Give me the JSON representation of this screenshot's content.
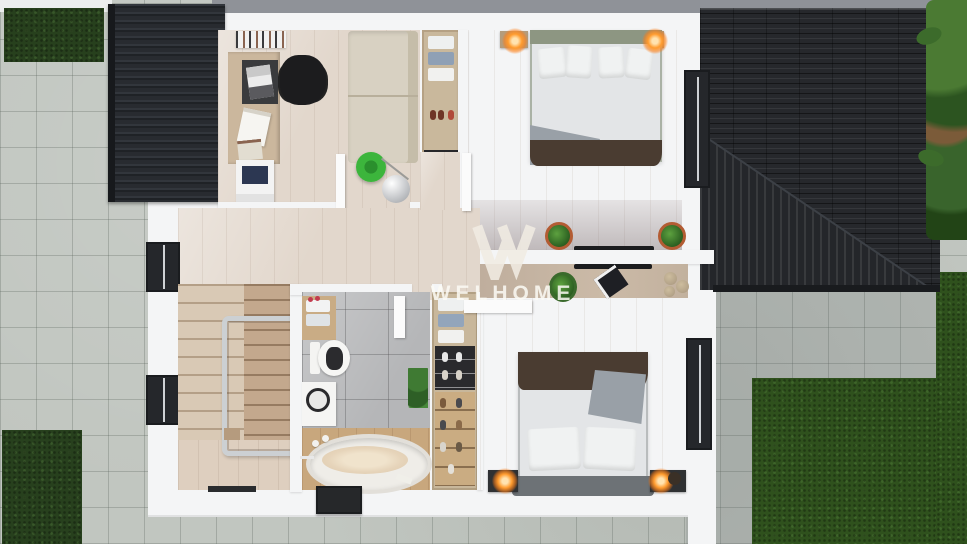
{
  "watermark": {
    "symbol": "W",
    "brand": "WELHOME"
  },
  "palette": {
    "paver": "#c1c6c0",
    "paver-line": "#99a099",
    "grass-dark": "#27401d",
    "grass-bright": "#2f511d",
    "roof": "#26282c",
    "wall": "#f4f5f6",
    "wood-floor": "#e2d7cc",
    "tile": "#b5b6b8",
    "sofa": "#d8d1c2",
    "bed-linen": "#e3e5e7",
    "blanket-brown": "#4a3c31",
    "throw-gray": "#99a0a7",
    "headboard-sage": "#8d9682",
    "headboard-gray": "#6d7276",
    "lamp-glow": "#ff9b2e",
    "stool-green": "#3cb53c",
    "plant-green": "#3e7a31",
    "dark-window": "#25272b",
    "watermark-color": "#f1ece3"
  }
}
